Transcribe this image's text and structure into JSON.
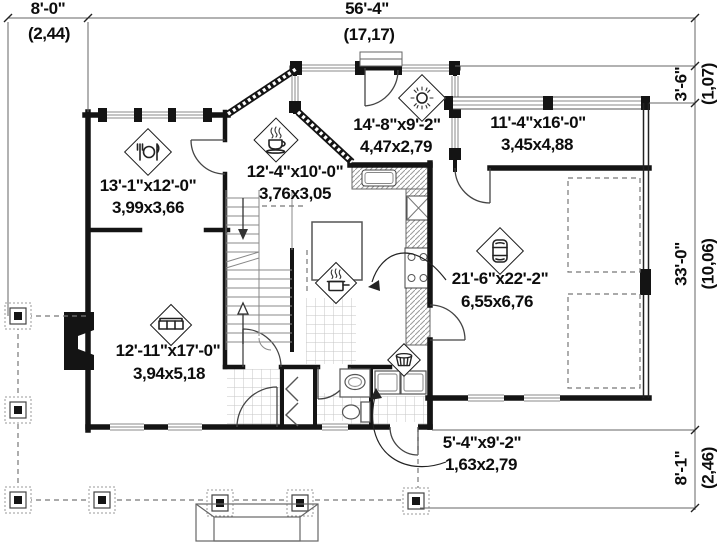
{
  "plan": {
    "title": "first-floor-plan",
    "dimensions": {
      "top_left": {
        "imperial": "8'-0\"",
        "metric": "(2,44)"
      },
      "top_width": {
        "imperial": "56'-4\"",
        "metric": "(17,17)"
      },
      "right_top": {
        "imperial": "3'-6\"",
        "metric": "(1,07)"
      },
      "right_mid": {
        "imperial": "33'-0\"",
        "metric": "(10,06)"
      },
      "right_bot": {
        "imperial": "8'-1\"",
        "metric": "(2,46)"
      }
    },
    "rooms": {
      "dining": {
        "imperial": "13'-1\"x12'-0\"",
        "metric": "3,99x3,66",
        "icon": "dining-icon"
      },
      "breakfast": {
        "imperial": "12'-4\"x10'-0\"",
        "metric": "3,76x3,05",
        "icon": "coffee-cup-icon"
      },
      "sunroom": {
        "imperial": "14'-8\"x9'-2\"",
        "metric": "4,47x2,79",
        "icon": "sun-icon"
      },
      "bonus": {
        "imperial": "11'-4\"x16'-0\"",
        "metric": "3,45x4,88"
      },
      "garage": {
        "imperial": "21'-6\"x22'-2\"",
        "metric": "6,55x6,76",
        "icon": "car-icon"
      },
      "living": {
        "imperial": "12'-11\"x17'-0\"",
        "metric": "3,94x5,18",
        "icon": "sofa-icon"
      },
      "laundry": {
        "imperial": "5'-4\"x9'-2\"",
        "metric": "1,63x2,79"
      },
      "kitchen": {
        "icon": "pot-icon"
      },
      "mudroom": {
        "icon": "laundry-basket-icon"
      }
    },
    "colors": {
      "wall": "#141414",
      "line": "#777777",
      "background": "#ffffff"
    }
  }
}
